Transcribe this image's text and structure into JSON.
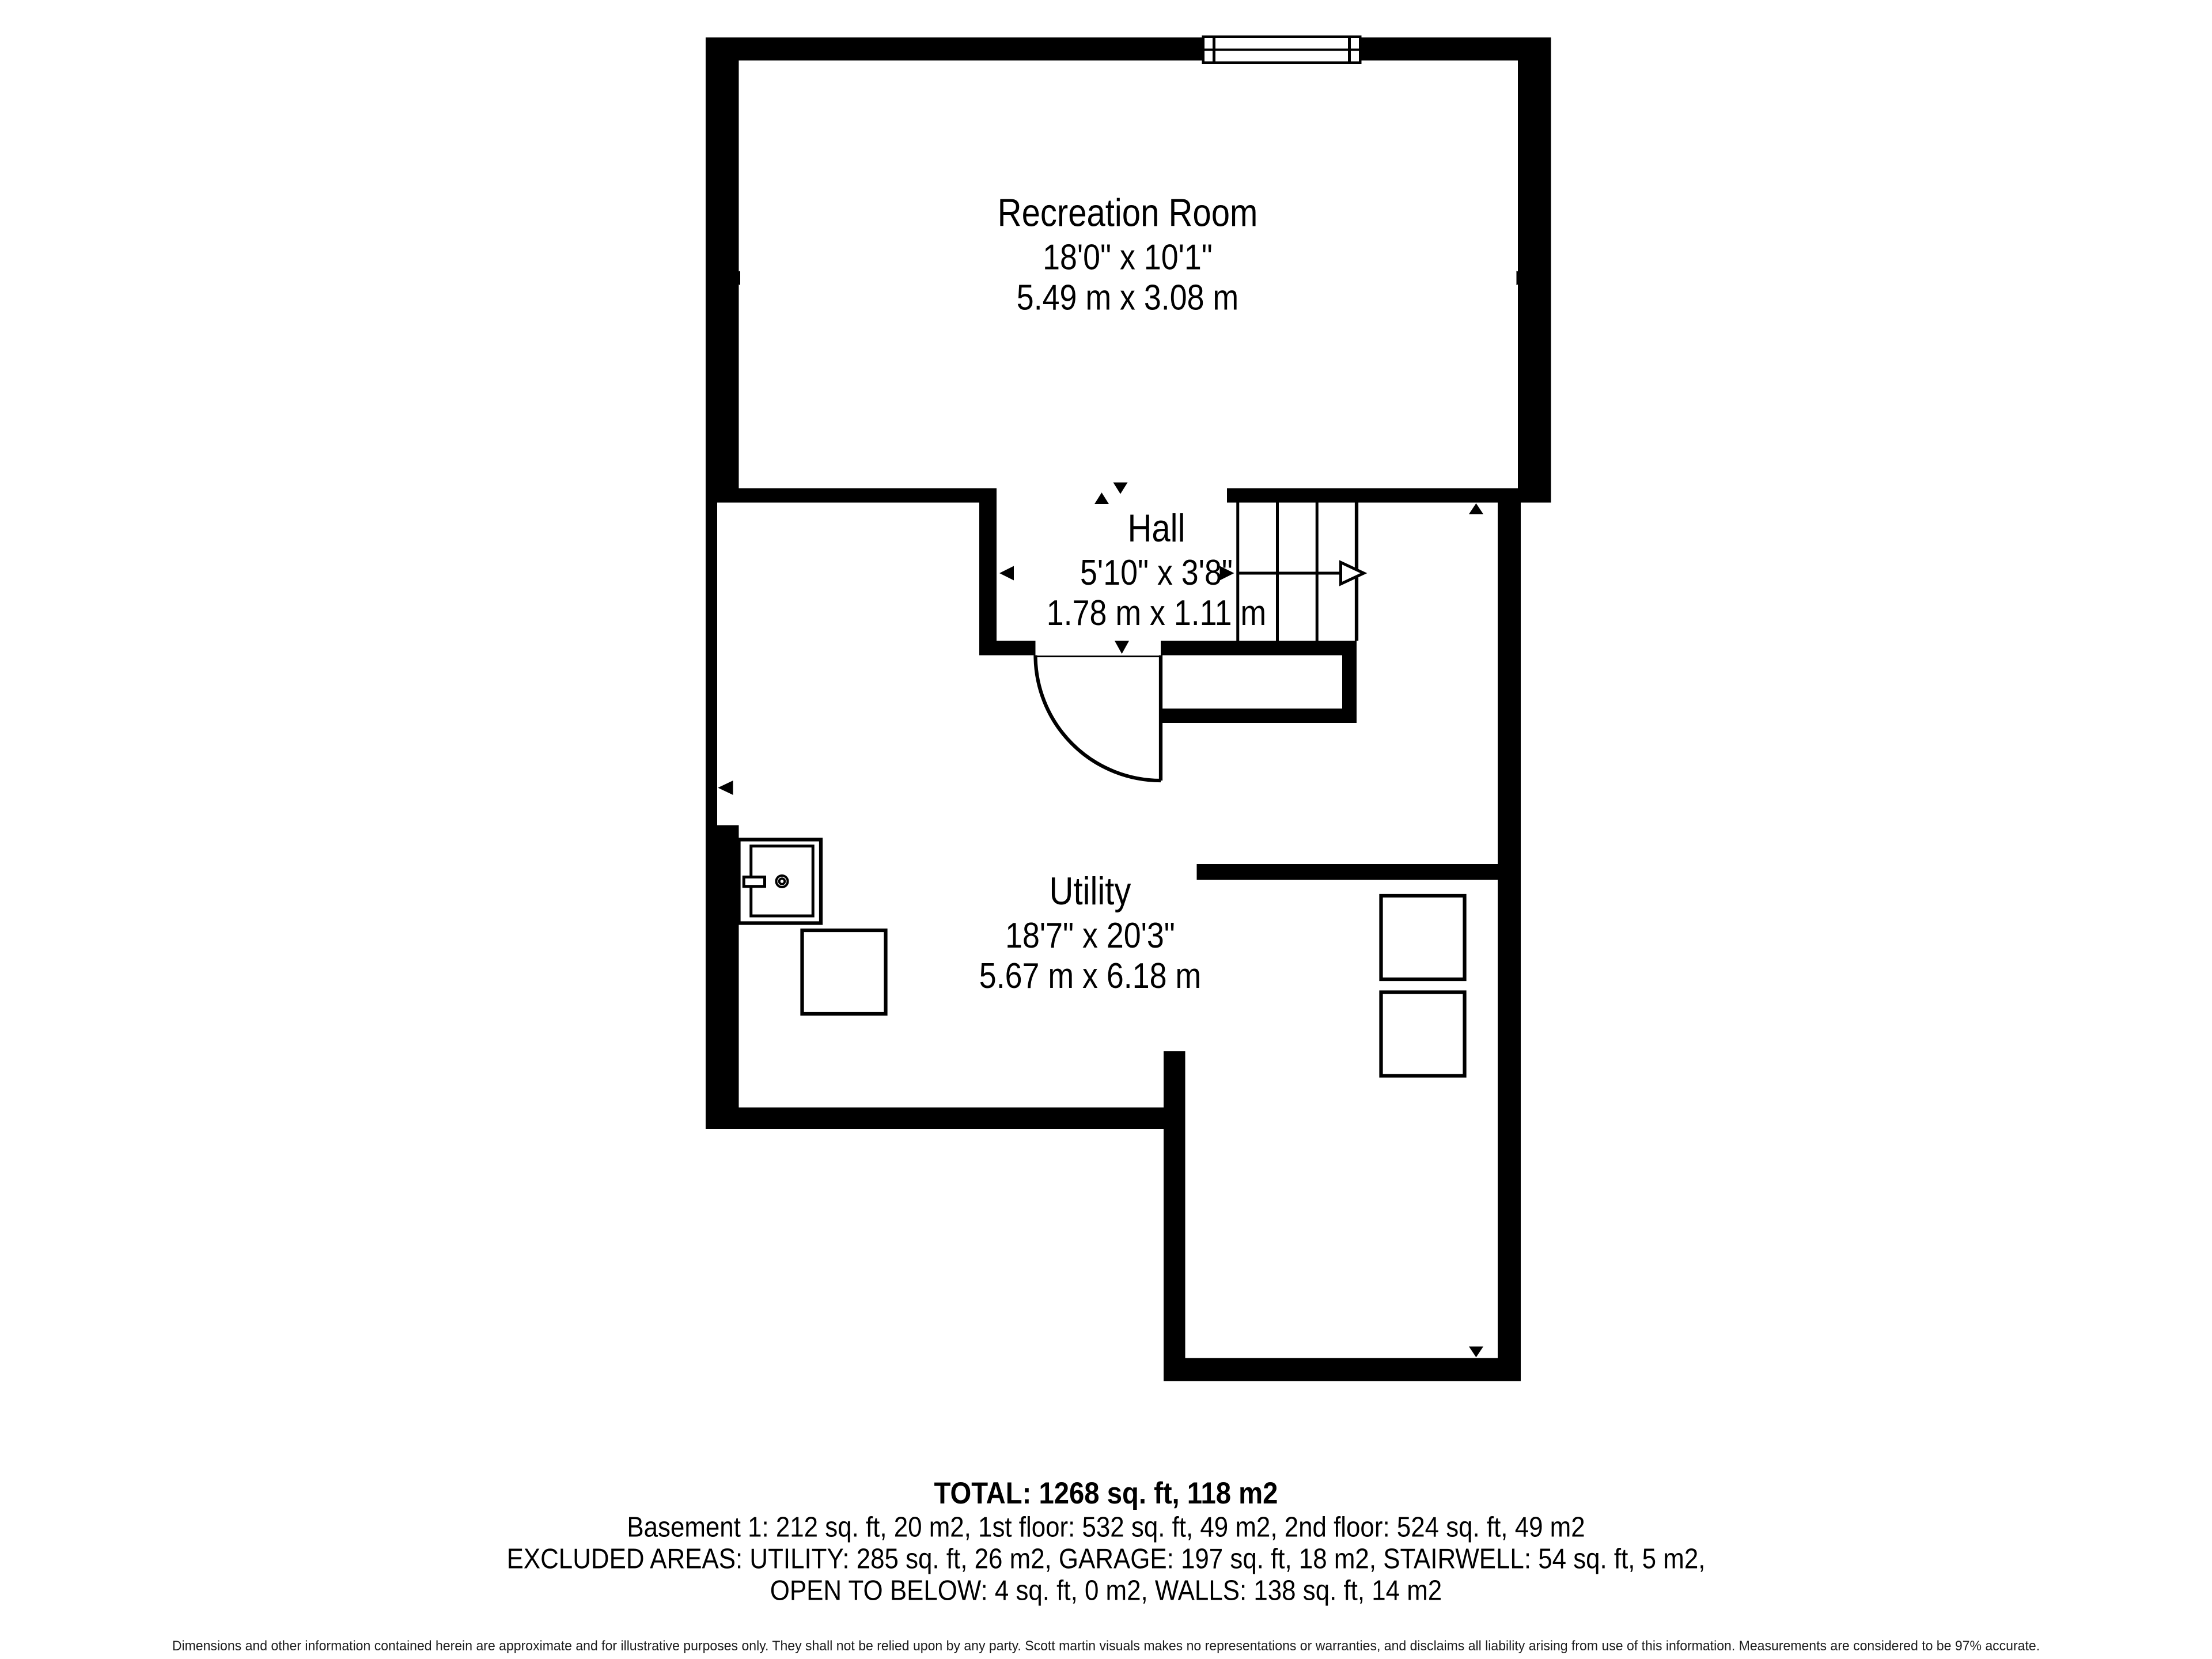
{
  "rooms": [
    {
      "name": "Recreation Room",
      "imperial": "18'0\" x 10'1\"",
      "metric": "5.49 m x 3.08 m"
    },
    {
      "name": "Hall",
      "imperial": "5'10\" x 3'8\"",
      "metric": "1.78 m x 1.11 m"
    },
    {
      "name": "Utility",
      "imperial": "18'7\" x 20'3\"",
      "metric": "5.67 m x 6.18 m"
    }
  ],
  "summary": {
    "total": "TOTAL: 1268 sq. ft, 118 m2",
    "floors": "Basement 1: 212 sq. ft, 20 m2, 1st floor: 532 sq. ft, 49 m2, 2nd floor: 524 sq. ft, 49 m2",
    "excluded_line1": "EXCLUDED AREAS: UTILITY: 285 sq. ft, 26 m2, GARAGE: 197 sq. ft, 18 m2, STAIRWELL: 54 sq. ft, 5 m2,",
    "excluded_line2": "OPEN TO BELOW: 4 sq. ft, 0 m2, WALLS: 138 sq. ft, 14 m2"
  },
  "disclaimer": "Dimensions and other information contained herein are approximate and for illustrative purposes only. They shall not be relied upon by any party. Scott martin visuals makes no representations or warranties, and disclaims all liability arising from use of this information. Measurements are considered to be 97% accurate.",
  "colors": {
    "wall": "#000000",
    "background": "#ffffff",
    "text": "#000000"
  }
}
